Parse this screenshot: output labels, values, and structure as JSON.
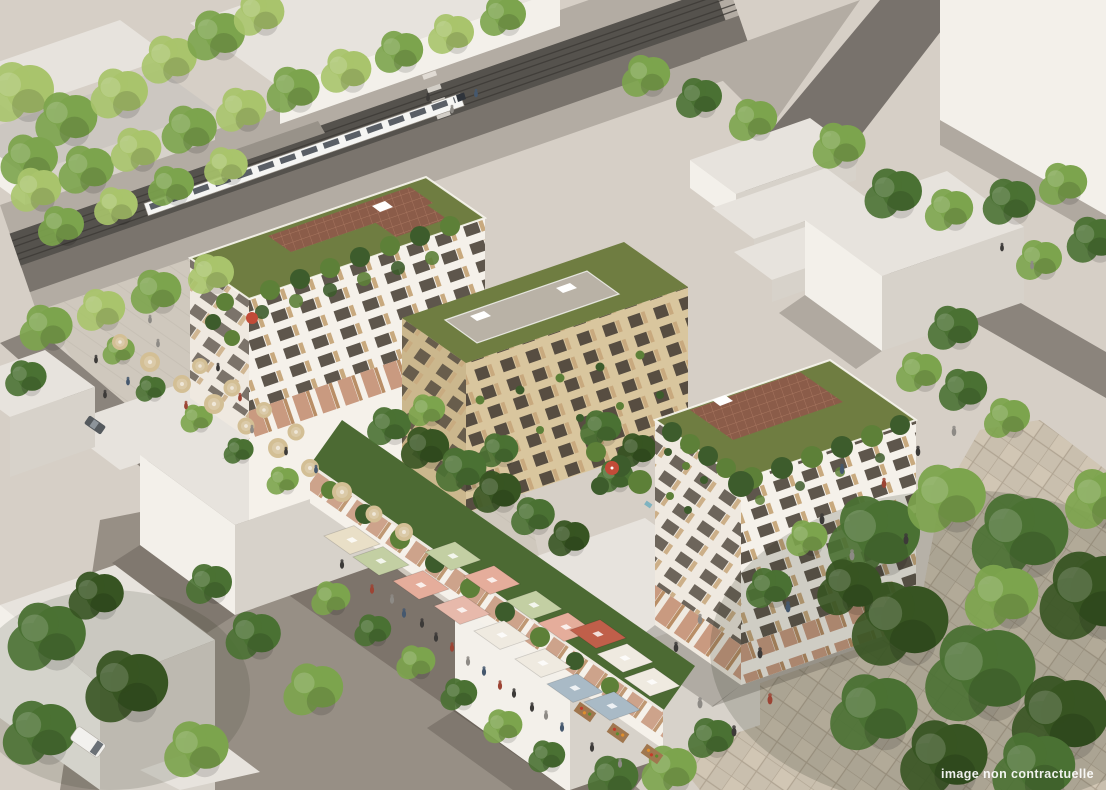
{
  "watermark": {
    "text": "image non contractuelle"
  },
  "palette": {
    "ground": "#d6cfc6",
    "sidewalk": "#b3aca3",
    "trackbed": "#55524d",
    "roadway": "#7a746d",
    "street-dark": "#78726c",
    "street-right": "#8b847c",
    "plaza-cafe": "#cfc8bd",
    "plaza-floor": "#978f85",
    "market-lane": "#7d746b",
    "pave-base": "#c9bfae",
    "pave-line": "#b0a492",
    "pave-light": "#d6ccba",
    "block-roof": "#e7e3dd",
    "block-roof-gray": "#ccc7c1",
    "block-face-lit": "#f3f0ea",
    "block-face-shade": "#d7d2ca",
    "white-face": "#f5f1ea",
    "white-face-warm": "#efe9e0",
    "beige": "#d9c69e",
    "beige-shade": "#cbb78d",
    "win-dark": "#5e564c",
    "win-wood": "#c8a97e",
    "win-beige-dark": "#574d41",
    "arcade-glass": "#c99a80",
    "arcade-wood": "#b98e66",
    "green-roof": "#6f7d41",
    "green-roof-line": "#5c6a36",
    "green-dark": "#4c6a33",
    "deck": "#b9b2a6",
    "brick": "#8b5c49",
    "brick-line": "#a8765f",
    "plant-dark": "#3d5c2c",
    "plant-mid": "#5d8038",
    "tree-light": "#a9c46c",
    "tree-mid": "#7ca44d",
    "tree-dark": "#4a7133",
    "tree-deep": "#375422",
    "canopy-cream": "#e9dfc7",
    "canopy-sage": "#c3cfa3",
    "canopy-salmon": "#e5ad9b",
    "canopy-pink": "#e7b9ab",
    "canopy-white": "#efeae0",
    "canopy-blue": "#a9bac6",
    "canopy-red": "#c05f4a",
    "umbrella-tan": "#d3bf95",
    "umbrella-red": "#c24b38",
    "tram-body": "#f5f5f3",
    "tram-window": "#3e444c",
    "watermark": "#ffffff"
  }
}
